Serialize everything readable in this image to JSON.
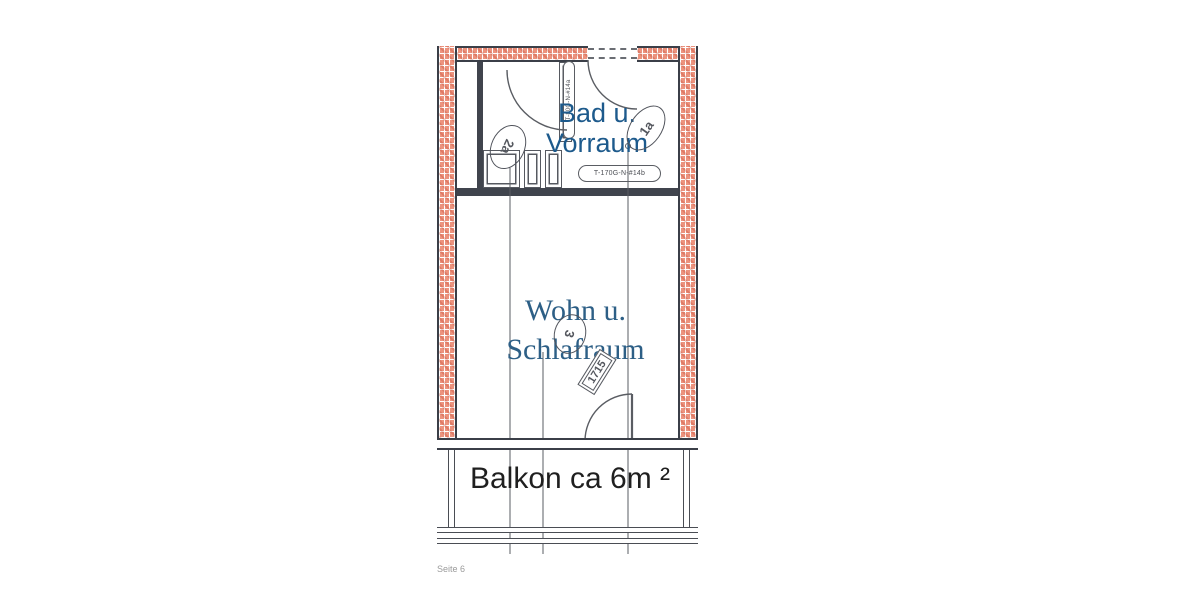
{
  "page": {
    "footer": {
      "page_label": "Seite 6"
    }
  },
  "floorplan": {
    "bad_room": {
      "line1": "Bad u.",
      "line2": "Vorraum"
    },
    "wohn_room": {
      "line1": "Wohn u.",
      "line2": "Schlafraum"
    },
    "balkon": {
      "label": "Balkon ca 6m ²"
    },
    "door_tags": {
      "interior_top": "T-170G-N-#14b",
      "interior_side": "T-80G-N-#14a"
    },
    "position_markers": {
      "marker_2a": "2a",
      "marker_1a": "1a",
      "marker_3": "3",
      "marker_1715": "1715"
    },
    "colors": {
      "brick": "#ec937e",
      "wall_outline": "#3b3f48",
      "thin_line": "#5a5d63",
      "bad_label": "#1d5a8c",
      "wohn_label": "#2d5f86",
      "balkon_label": "#1f1f1f",
      "footer_gray": "#9a9a9a"
    }
  }
}
